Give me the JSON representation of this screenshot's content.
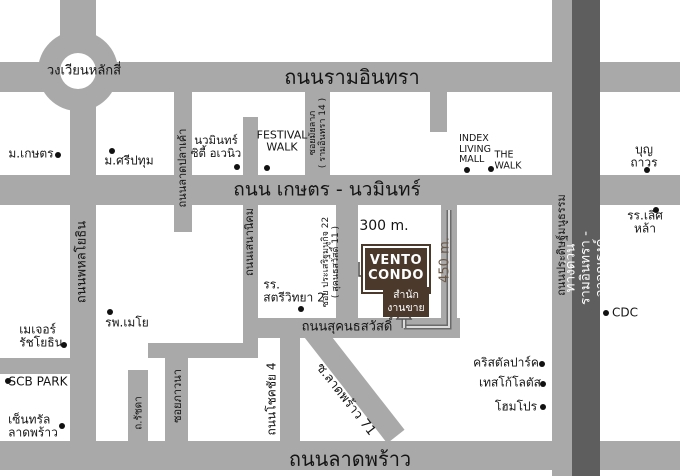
{
  "roads": {
    "ram_inthra": "ถนนรามอินทรา",
    "kaset_nawamin": "ถนน เกษตร - นวมินทร์",
    "lat_phrao": "ถนนลาดพร้าว",
    "sukhonthasawat": "ถนนสุคนธสวัสดิ์",
    "phahon_yothin": "ถนนพหลโยธิน",
    "lat_pla_khao": "ถนนลาดปลาเค้า",
    "sena_nikhom": "ถนนเสนานิคม",
    "mailap": "ซอยมัยลาภ\n( รามอินทรา 14 )",
    "prasert_manukit_22": "ซอย ประเสริฐมนูกิจ 22\n( สุคนธสวัสดิ์ 11 )",
    "phawana": "ซอยภาวนา",
    "chokchai_4": "ถนนโชคชัย 4",
    "ratchada": "ถ.รัชดา",
    "lat_phrao_71": "ซ.ลาดพร้าว 71",
    "pradit_manutham": "ถนนประดิษฐ์มนูธรรม",
    "expressway": "ทางด่วนรามอินทรา - อาจณรงค์",
    "lak_si_roundabout": "วงเวียนหลักสี่"
  },
  "landmarks": {
    "kaset_university": "ม.เกษตร",
    "sripatum_university": "ม.ศรีปทุม",
    "nawamin_city_avenue": "นวมินทร์\nซิตี้ อเวนิว",
    "festival_walk": "FESTIVAL\nWALK",
    "index_living_mall": "INDEX\nLIVING\nMALL",
    "the_walk": "THE\nWALK",
    "boonthavorn": "บุญถาวร",
    "lertlah_school": "รร.เลิศหล้า",
    "cdc": "CDC",
    "satriwithaya_2_school": "รร.\nสตรีวิทยา 2",
    "mayo_hospital": "รพ.เมโย",
    "major_ratchayothin": "เมเจอร์\nรัชโยธิน",
    "scb_park": "SCB PARK",
    "central_ladprao": "เซ็นทรัล\nลาดพร้าว",
    "crystal_park": "คริสตัลปาร์ค",
    "tesco_lotus": "เทสโก้โลตัส",
    "homepro": "โฮมโปร"
  },
  "project": {
    "name": "VENTO\nCONDO",
    "sales_office": "สำนัก\nงานขาย",
    "distance_300": "300 m.",
    "distance_450": "450 m."
  },
  "colors": {
    "road": "#a9a9a9",
    "expressway": "#5e5e5e",
    "brand_brown": "#4b392c",
    "distance_brown": "#6b5947"
  }
}
